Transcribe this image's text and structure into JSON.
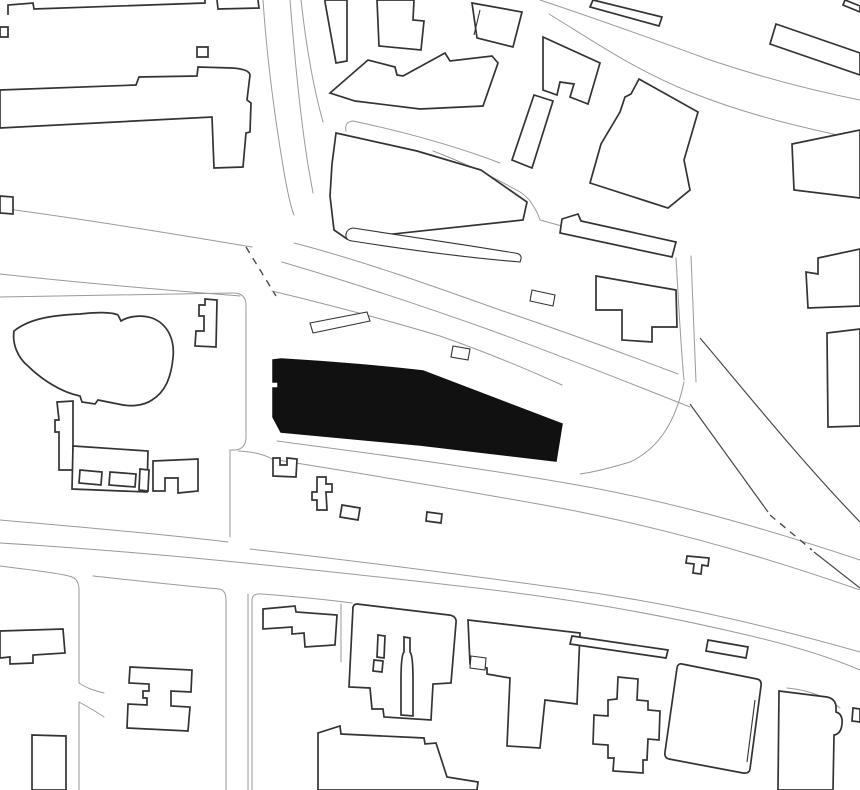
{
  "meta": {
    "title": "architectural-site-plan",
    "description": "Black and white figure-ground site plan with one building highlighted in solid black",
    "canvas": {
      "width": 860,
      "height": 790
    },
    "colors": {
      "background": "#ffffff",
      "building_outline": "#333333",
      "road_line": "#9a9a9a",
      "rail_line": "#4a4a4a",
      "highlight_fill": "#111111"
    }
  },
  "map": {
    "site_building": {
      "name": "highlighted-site-building",
      "fill": "#111111",
      "path": "M273,360 L281,359 C330,362 380,366 423,371 L562,424 L556,461 L420,445 L281,432 L273,417 L273,388 L278,388 L278,382 L273,382 Z"
    },
    "roads": [
      {
        "name": "road-top-vertical-west-edge",
        "d": "M263,0 C266,45 273,105 282,160 C286,185 290,205 294,215"
      },
      {
        "name": "road-top-vertical-east-edge",
        "d": "M290,0 C294,50 300,115 308,165 L313,193"
      },
      {
        "name": "road-top-fork-line",
        "d": "M301,0 C306,45 314,90 323,122"
      },
      {
        "name": "road-west-street-north-edge",
        "d": "M0,208 C90,220 180,235 252,247"
      },
      {
        "name": "road-west-street-south-edge",
        "d": "M0,274 C100,285 190,292 240,296"
      },
      {
        "name": "block-midleft-boundary",
        "d": "M0,297 L233,293 Q246,293 246,305 L246,437 Q246,449 235,450 L230,450"
      },
      {
        "name": "road-vertical-center-west",
        "d": "M230,450 L230,537"
      },
      {
        "name": "block-midleft-bottom-edge",
        "d": "M0,520 C80,527 160,534 228,542"
      },
      {
        "name": "street-bottom-south-edge",
        "d": "M0,543 C150,552 300,568 450,585 C560,597 650,612 747,635 C790,645 830,657 860,670"
      },
      {
        "name": "street-bottom-north-edge",
        "d": "M250,549 C350,560 450,573 560,588 C650,600 740,618 860,652"
      },
      {
        "name": "street-below-site-block-edge",
        "d": "M238,451 Q260,452 272,459 C350,472 440,486 560,508 C660,527 760,555 860,590"
      },
      {
        "name": "street-below-site-sidewalk",
        "d": "M277,441 C360,452 460,465 560,482 C650,497 740,520 860,560"
      },
      {
        "name": "road-main-diagonal-north-edge",
        "d": "M294,243 C360,260 430,285 500,310 C560,330 620,352 678,374"
      },
      {
        "name": "road-main-diagonal-middle-edge",
        "d": "M282,262 C350,282 420,305 490,330 C550,352 610,375 690,407"
      },
      {
        "name": "road-main-diagonal-south-lane",
        "d": "M272,291 C330,305 380,318 440,336 C480,350 520,366 562,385"
      },
      {
        "name": "road-northeast-vertical-west",
        "d": "M676,258 C679,310 681,350 684,380"
      },
      {
        "name": "road-northeast-vertical-east",
        "d": "M691,256 C693,310 695,350 696,382"
      },
      {
        "name": "road-slip-curve",
        "d": "M684,382 C676,420 660,448 630,462 C610,468 595,472 580,474"
      },
      {
        "name": "road-wrap-wedge-tip",
        "d": "M433,151 C465,163 495,178 520,192 Q529,198 532,204 Q537,211 540,220 C575,230 625,242 674,251"
      },
      {
        "name": "lane-strip-upper",
        "d": "M346,131 Q344,122 353,121 C400,131 450,144 500,163"
      },
      {
        "name": "boulevard-upper-edge",
        "d": "M540,0 C585,15 650,38 710,60 C770,80 820,92 860,100"
      },
      {
        "name": "boulevard-lower-edge",
        "d": "M549,14 C595,42 635,70 690,92 C750,116 805,128 860,140"
      },
      {
        "name": "road-bottomleft-block-west",
        "d": "M0,566 C40,571 64,574 72,577 Q79,580 79,590 L79,683"
      },
      {
        "name": "road-bottomleft-west-lower",
        "d": "M79,702 L79,790"
      },
      {
        "name": "driveway-curve-upper",
        "d": "M79,683 C88,689 96,691 104,693"
      },
      {
        "name": "driveway-curve-lower",
        "d": "M79,702 C88,707 97,712 104,717"
      },
      {
        "name": "block-hbuilding-boundary",
        "d": "M93,576 C140,581 185,586 219,589 Q226,590 226,600 L226,790"
      },
      {
        "name": "road-bottom-center-west-edge",
        "d": "M248,594 L248,790"
      },
      {
        "name": "block-church-west-edge",
        "d": "M252,790 L252,600 Q252,593 262,594 C300,597 330,600 352,603"
      },
      {
        "name": "lane-bottom-center",
        "d": "M341,604 L341,662"
      },
      {
        "name": "curve-around-tall-building",
        "d": "M787,688 C810,690 828,698 840,708"
      }
    ],
    "rails": [
      {
        "name": "rail-diagonal-long",
        "d": "M700,338 C740,385 800,460 860,522"
      },
      {
        "name": "rail-diagonal-short-a",
        "d": "M690,404 L768,512"
      },
      {
        "name": "rail-diagonal-short-b",
        "d": "M814,552 L860,588"
      }
    ],
    "dashed": [
      {
        "name": "dashed-boundary-junction",
        "d": "M246,247 L276,296"
      },
      {
        "name": "dashed-boundary-southeast",
        "d": "M770,515 L812,550"
      }
    ],
    "buildings": [
      {
        "name": "bldg-topleft-partial-a",
        "open": true,
        "d": "M8,15 L8,5 L33,3 L34,9 L205,3 L205,0"
      },
      {
        "name": "bldg-topleft-partial-b",
        "open": true,
        "d": "M217,0 L218,9 L259,8 L258,0"
      },
      {
        "name": "bldg-small-square",
        "d": "M197,47 L208,47 L208,57 L197,57 Z"
      },
      {
        "name": "bldg-topleft-slab-tower",
        "d": "M0,90 L136,85 L139,77 L197,76 L198,67 L232,68 Q249,69 250,75 L247,100 L251,103 L250,132 L246,133 L243,167 L214,168 L212,117 L0,128 Z"
      },
      {
        "name": "bldg-leftedge-partial-a",
        "d": "M0,196 L13,197 L13,214 L0,213 Z"
      },
      {
        "name": "bldg-leftedge-partial-b",
        "d": "M0,27 L8,27 L8,37 L0,37 Z"
      },
      {
        "name": "bldg-topmid-narrow",
        "d": "M325,0 L347,0 L347,61 L336,63 L325,2 Z"
      },
      {
        "name": "bldg-topmid-stepped",
        "d": "M377,0 L414,0 L413,20 L424,21 L421,50 L379,46 Z"
      },
      {
        "name": "bldg-topmid-slanted",
        "d": "M472,3 L522,12 L513,47 L477,38 Z"
      },
      {
        "name": "bldg-topmid-slanted-innerline",
        "open": true,
        "thin": true,
        "d": "M480,10 L474,35"
      },
      {
        "name": "bldg-topmid-jagged",
        "d": "M330,93 L368,60 L395,67 L397,75 L403,76 L445,53 L450,61 L492,56 L498,63 L483,106 L420,109 L355,101 Z"
      },
      {
        "name": "bldg-wedge-block",
        "d": "M336,133 L417,151 L481,170 L527,202 L523,220 L347,239 L334,230 L330,196 L332,164 Z"
      },
      {
        "name": "strip-lower-rounded",
        "thin": true,
        "d": "M353,228 C400,235 460,244 515,253 Q522,254 521,259 L520,262 C470,258 410,250 352,241 Q345,240 346,234 Q347,229 353,228 Z"
      },
      {
        "name": "bldg-cluster-seven-upper",
        "d": "M543,37 L600,63 L588,104 L570,97 L574,84 L560,82 L557,95 L543,90 Z"
      },
      {
        "name": "bldg-cluster-seven-lower",
        "d": "M534,95 L553,101 L532,168 L512,160 Z"
      },
      {
        "name": "bldg-topright-partial",
        "d": "M593,0 L662,17 L659,26 L590,7 Z"
      },
      {
        "name": "bldg-topright-longslab",
        "d": "M776,24 L860,53 L860,75 L770,44 Z"
      },
      {
        "name": "bldg-topright-corner",
        "d": "M845,0 L860,6 L860,12 L843,5 Z"
      },
      {
        "name": "bldg-midright-big",
        "d": "M639,79 L698,112 L684,160 L690,190 L668,208 L590,183 L601,144 L620,112 L625,97 L631,94 Z"
      },
      {
        "name": "bldg-midright-slab",
        "d": "M562,219 L578,214 L581,221 L676,242 L672,257 L560,233 Z"
      },
      {
        "name": "bldg-midright-stepped",
        "d": "M596,276 L676,290 L677,327 L652,327 L652,342 L622,340 L622,310 L596,310 Z"
      },
      {
        "name": "bldg-rightedge-a",
        "d": "M792,144 L860,130 L860,198 L794,190 Z"
      },
      {
        "name": "bldg-rightedge-b",
        "d": "M818,258 L860,249 L860,306 L808,308 L806,272 L818,274 Z"
      },
      {
        "name": "bldg-rightedge-c",
        "d": "M827,333 L860,329 L860,426 L828,427 Z"
      },
      {
        "name": "bldg-bump-road-a",
        "thin": true,
        "d": "M532,290 L555,295 L553,306 L530,301 Z"
      },
      {
        "name": "bldg-bump-road-b",
        "thin": true,
        "d": "M453,346 L470,349 L468,360 L451,357 Z"
      },
      {
        "name": "island-parallelogram",
        "thin": true,
        "d": "M310,323 L367,312 L370,321 L313,333 Z"
      },
      {
        "name": "bldg-blob-organic",
        "d": "M14,331 C30,318 55,315 80,314 C95,312 112,312 118,315 L121,321 C127,317 140,314 152,318 C168,324 175,340 173,358 C171,378 165,392 152,400 C143,406 130,407 118,404 L98,400 L95,404 L82,402 L80,396 C60,392 40,378 28,366 C18,358 12,344 14,331 Z"
      },
      {
        "name": "bldg-midleft-f-shape",
        "d": "M205,299 L217,300 L216,347 L195,346 L196,331 L204,331 L204,316 L199,316 L199,305 L205,305 Z"
      },
      {
        "name": "bldg-midleft-leftwing",
        "d": "M57,402 L73,401 L73,470 L59,470 L59,432 L55,432 L55,420 L59,420 Z"
      },
      {
        "name": "bldg-midleft-bottomwing",
        "d": "M73,446 L148,451 L147,492 L72,489 Z"
      },
      {
        "name": "bldg-midleft-rightpart",
        "d": "M153,461 L198,459 L198,491 L178,493 L178,478 L165,478 L165,491 L153,491 Z"
      },
      {
        "name": "bldg-midleft-small-1",
        "d": "M80,470 L102,472 L101,485 L79,483 Z"
      },
      {
        "name": "bldg-midleft-small-2",
        "d": "M110,472 L136,474 L135,487 L109,485 Z"
      },
      {
        "name": "bldg-midleft-small-3",
        "d": "M140,469 L149,470 L148,491 L139,490 Z"
      },
      {
        "name": "bldg-belowsite-stepped",
        "d": "M273,458 L280,458 L280,465 L287,465 L287,458 L297,459 L296,477 L273,476 Z"
      },
      {
        "name": "bldg-belowsite-cross",
        "d": "M317,477 L326,477 L326,484 L332,484 L332,492 L326,492 L327,510 L317,510 L317,500 L312,500 L312,492 L317,492 Z"
      },
      {
        "name": "bldg-belowsite-small-a",
        "d": "M342,505 L360,508 L358,520 L340,517 Z"
      },
      {
        "name": "bldg-belowsite-small-b",
        "d": "M427,512 L442,514 L441,523 L426,521 Z"
      },
      {
        "name": "bldg-t-shape-small",
        "d": "M687,556 L709,558 L708,566 L702,565 L701,574 L693,573 L694,564 L686,563 Z"
      },
      {
        "name": "bldg-bottomleft-notched",
        "d": "M0,631 L63,629 L65,653 L33,655 L33,663 L10,664 L10,657 L0,658 Z"
      },
      {
        "name": "bldg-h-shape",
        "d": "M130,667 L192,670 L191,692 L171,691 L171,706 L190,707 L188,731 L127,728 L128,704 L147,705 L147,698 L143,698 L143,691 L149,691 L149,684 L129,683 Z"
      },
      {
        "name": "bldg-bottomleft-rect",
        "d": "M32,735 L66,736 L66,790 L32,790 Z"
      },
      {
        "name": "bldg-bottomcenter-notched",
        "d": "M263,609 L295,606 L296,612 L337,615 L335,645 L305,647 L304,633 L292,634 L292,627 L263,629 Z"
      },
      {
        "name": "bldg-church-block",
        "d": "M357,604 L449,615 Q457,616 456,623 L451,683 L433,684 L431,720 L384,717 L383,709 L372,709 L370,688 L349,687 L353,607 Q354,604 357,604 Z"
      },
      {
        "name": "courtyard-slot",
        "d": "M378,635 L385,636 L384,658 L377,657 Z"
      },
      {
        "name": "courtyard-hook",
        "d": "M374,660 L383,661 L382,672 L373,671 Z"
      },
      {
        "name": "courtyard-bottle",
        "d": "M404,637 L410,638 L410,652 Q413,655 413,680 L413,716 L401,715 L401,680 Q401,655 404,652 Z"
      },
      {
        "name": "bldg-bottomcenter-jagged",
        "d": "M468,620 L580,633 L577,704 L545,700 L540,748 L507,746 L510,678 L487,674 L487,668 L470,664 Z"
      },
      {
        "name": "bldg-bottomcenter-innersq",
        "thin": true,
        "d": "M471,656 L486,658 L485,670 L470,668 Z"
      },
      {
        "name": "bldg-bottom-bigslab",
        "d": "M318,790 L318,733 L340,726 L341,734 L424,738 L425,744 L436,743 L447,777 L478,782 L477,790 Z"
      },
      {
        "name": "strip-thin-bottomright",
        "d": "M572,636 L668,650 L666,658 L570,644 Z"
      },
      {
        "name": "strip-small-bottomright",
        "d": "M708,640 L748,647 L746,658 L706,651 Z"
      },
      {
        "name": "bldg-cruciform",
        "d": "M618,677 L638,679 L637,700 L648,701 L648,710 L660,711 L659,740 L648,739 L647,760 L643,760 L643,773 L613,771 L614,758 L608,758 L608,745 L593,744 L594,715 L608,716 L608,700 L617,699 Z"
      },
      {
        "name": "bldg-rounded-large",
        "d": "M682,664 L757,679 Q762,680 761,686 L750,769 Q749,774 743,773 L669,759 Q664,758 665,752 L677,668 Q678,663 682,664 Z"
      },
      {
        "name": "bldg-rounded-innerline",
        "open": true,
        "thin": true,
        "d": "M755,700 L747,762"
      },
      {
        "name": "bldg-tall-right",
        "d": "M779,691 L827,697 Q837,699 836,710 L836,712 Q843,714 842,724 Q841,734 834,735 L833,790 L778,790 Z"
      },
      {
        "name": "bldg-rightedge-tiny",
        "d": "M853,708 L860,709 L860,722 L852,721 Z"
      }
    ]
  }
}
